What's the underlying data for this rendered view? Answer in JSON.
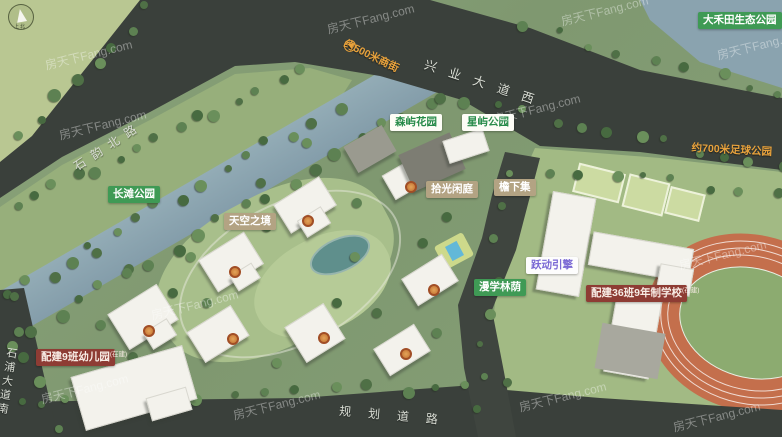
{
  "watermark": "房天下Fang.com",
  "compass_caption": "上北",
  "roads": {
    "north_road": "石韵北路",
    "xingye_avenue": "兴业大道西",
    "planned_road": "规划道路",
    "shipu_avenue": "石浦大道南",
    "river_name": "屏山河"
  },
  "distance_labels": {
    "street": "约500米商街",
    "street_arrow": "◀",
    "football_park": "约700米足球公园"
  },
  "parks": {
    "changtan": "长滩公园",
    "dahetian": "大禾田生态公园",
    "senyu": "森屿花园",
    "xingyu": "星屿公园",
    "manxue": "漫学林荫"
  },
  "amenities": {
    "tiankong": "天空之境",
    "shiguang": "拾光闲庭",
    "yanxia": "檐下集",
    "yuedong": "跃动引擎"
  },
  "facilities": {
    "school": {
      "text": "配建36班9年制学校",
      "suffix": "(在建)"
    },
    "kindergarten": {
      "text": "配建9班幼儿园",
      "suffix": "(在建)"
    }
  },
  "colors": {
    "road": "#3a403b",
    "river": "#8aa3af",
    "park_label_green": "#3f9a55",
    "amenity_tan": "#b3a383",
    "facility_red": "#8e3c34",
    "distance_orange": "#e8a23c",
    "accent_purple": "#7a68d4",
    "track_orange": "#c46f4c"
  }
}
